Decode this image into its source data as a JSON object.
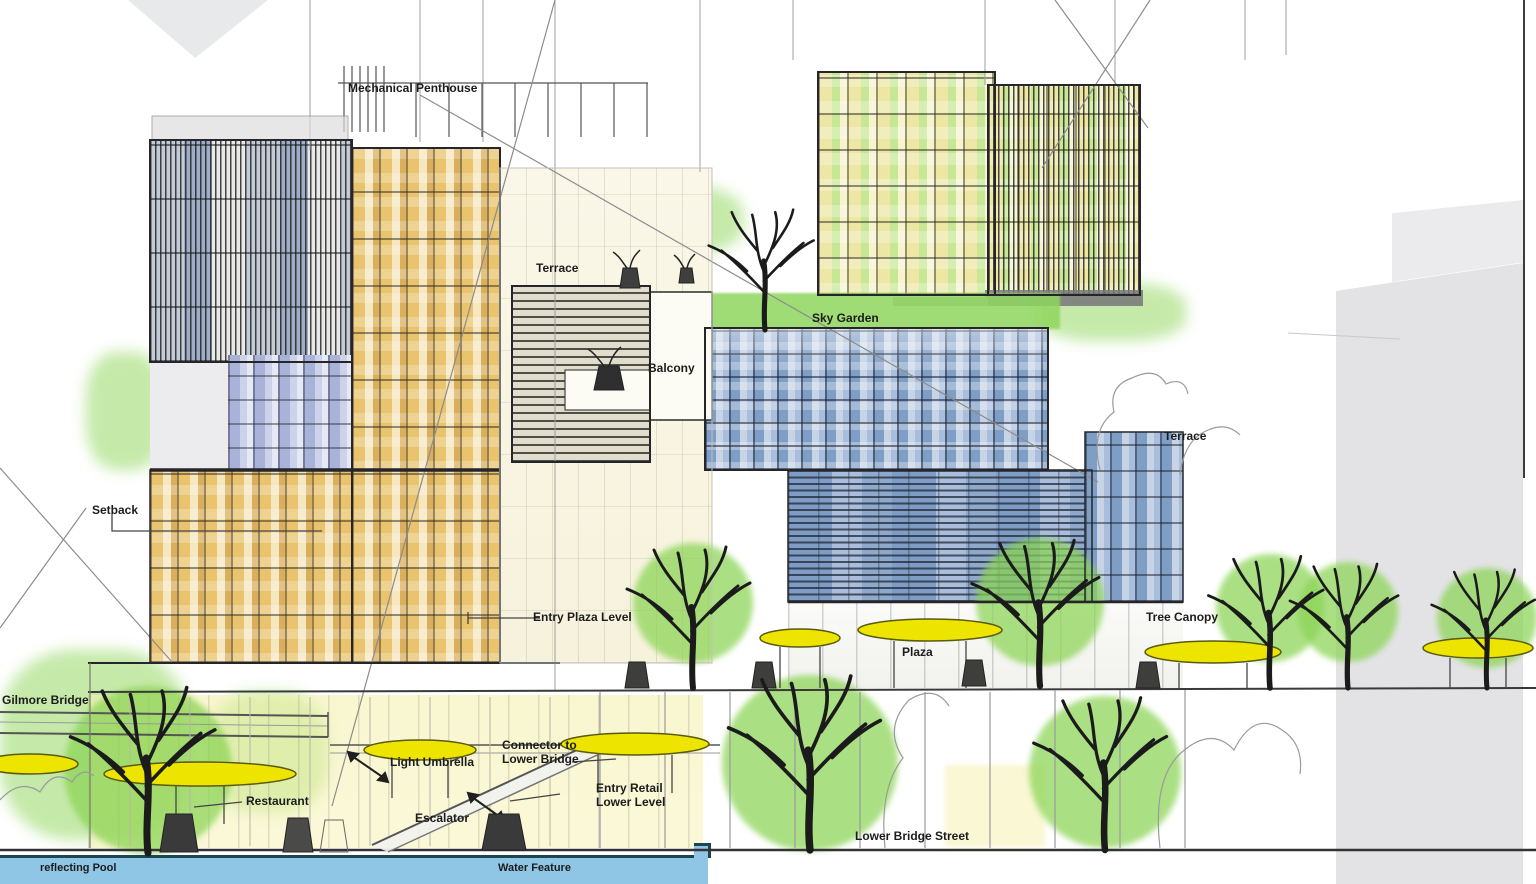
{
  "drawing": {
    "title": "Mixed-use building elevation sketch",
    "labels": {
      "mechanical_penthouse": "Mechanical Penthouse",
      "terrace_upper": "Terrace",
      "balcony": "Balcony",
      "sky_garden": "Sky Garden",
      "terrace_right": "Terrace",
      "setback": "Setback",
      "entry_plaza_level": "Entry Plaza Level",
      "plaza": "Plaza",
      "tree_canopy": "Tree Canopy",
      "gilmore_bridge": "Gilmore Bridge",
      "light_umbrella": "Light Umbrella",
      "connector_line1": "Connector to",
      "connector_line2": "Lower Bridge",
      "restaurant": "Restaurant",
      "escalator": "Escalator",
      "entry_retail_line1": "Entry Retail",
      "entry_retail_line2": "Lower Level",
      "lower_bridge_street": "Lower Bridge Street",
      "reflecting_pool": "reflecting Pool",
      "water_feature": "Water Feature"
    }
  },
  "colors": {
    "water_blue": "#8FC6E6",
    "umbrella_yellow": "#EDE400",
    "tree_green": "#8BD454",
    "sky_garden_green": "#8FD65E",
    "facade_orange": "#E9C36E",
    "facade_orange_light": "#F5E7C0",
    "facade_blue": "#7F9EC6",
    "facade_blue_light": "#C6D4E6",
    "facade_yellow": "#EDE6A4",
    "facade_green": "#C8E794",
    "background_building_gray": "#E3E3E5",
    "linework_dark": "#2B2B28"
  }
}
